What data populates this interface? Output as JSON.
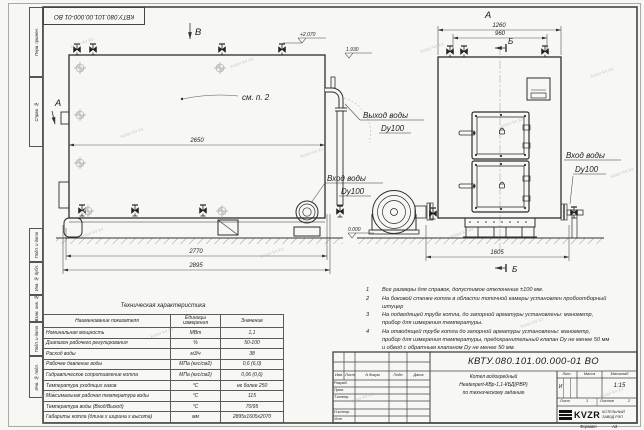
{
  "watermark": {
    "text": "kotel-kv.kz"
  },
  "corner_stamp": "КВТУ.080.101.00.000-01 ВО",
  "margin": {
    "perv_primen": "Перв. примен.",
    "sprav_no": "Справ. №",
    "podp_data_1": "Подп. и дата",
    "inv_dubl": "Инв. № дубл.",
    "vzam_inv": "Взам. инв. №",
    "podp_data_2": "Подп. и дата",
    "inv_podl": "Инв. № подл."
  },
  "drawing": {
    "side_view": {
      "view_label_b": "В",
      "section_label_a": "А",
      "callout": "см. п. 2",
      "dim_inner": "2650",
      "dim_base": "2770",
      "dim_overall": "2895",
      "elev_top": "+2.070",
      "elev_outlet": "1.930",
      "elev_zero": "0.000",
      "outlet_label": "Выход воды",
      "outlet_dn": "Dy100",
      "inlet_label": "Вход воды",
      "inlet_dn": "Dy100"
    },
    "front_view": {
      "view_label_a": "А",
      "dim_body": "1260",
      "dim_hatch": "960",
      "dim_overall": "1605",
      "section_label_top": "Б",
      "section_label_bottom": "Б",
      "inlet_label": "Вход воды",
      "inlet_dn": "Dy100"
    }
  },
  "notes": [
    {
      "num": "1",
      "text": "Все размеры для справок, допустимое отклонение ±100 мм."
    },
    {
      "num": "2",
      "text": "На боковой стенке котла в области топочной камеры установлен пробоотборный штуцер"
    },
    {
      "num": "3",
      "text": "На подводящей трубе котла, до запорной арматуры установлены: манометр, прибор для измерения температуры."
    },
    {
      "num": "4",
      "text": "На отводящей трубе котла до запорной арматуры установлены: манометр, прибор для измерения температуры, предохранительный клапан Dу не менее 50 мм и обвод с обратным клапаном Dу не менее 50 мм."
    }
  ],
  "tech_table": {
    "title": "Техническая характеристика",
    "headers": [
      "Наименование показателя",
      "Единицы измерения",
      "Значение"
    ],
    "rows": [
      [
        "Номинальная мощность",
        "МВт",
        "1,1"
      ],
      [
        "Диапазон рабочего регулирования",
        "%",
        "50-100"
      ],
      [
        "Расход воды",
        "м3/ч",
        "38"
      ],
      [
        "Рабочее давление воды",
        "МПа (кгс/см2)",
        "0,6 (6,0)"
      ],
      [
        "Гидравлическое сопротивление котла",
        "МПа (кгс/см2)",
        "0,06 (0,6)"
      ],
      [
        "Температура уходящих газов",
        "°С",
        "не более 250"
      ],
      [
        "Максимальная рабочая температура воды",
        "°С",
        "115"
      ],
      [
        "Температура воды (Вход/Выход)",
        "°С",
        "70/95"
      ],
      [
        "Габариты котла (длина х ширина х высота)",
        "мм",
        "2895х1605х2070"
      ]
    ]
  },
  "title_block": {
    "designation": "КВТУ.080.101.00.000-01 ВО",
    "name_line1": "Котел водогрейный",
    "name_line2": "Heatexpert-КВр-1,1-КБД(РВР)",
    "name_line3": "по техническому заданию",
    "col_izm": "Изм.",
    "col_list": "Лист",
    "col_ndoc": "N докум.",
    "col_podp": "Подп.",
    "col_data": "Дата",
    "row_razrab": "Разраб.",
    "row_prov": "Пров.",
    "row_tkontr": "Т.контр.",
    "row_nkontr": "Н.контр.",
    "row_utv": "Утв.",
    "lit_label": "Лит.",
    "mass_label": "Масса",
    "scale_label": "Масштаб",
    "lit_value": "И",
    "scale_value": "1:15",
    "sheet_label": "Лист",
    "sheet_value": "1",
    "sheets_label": "Листов",
    "sheets_value": "2",
    "logo": "KVZR",
    "company_line1": "КОТЕЛЬНЫЙ",
    "company_line2": "ЗАВОД РЭП",
    "format_label": "Формат",
    "format_value": "А3"
  }
}
